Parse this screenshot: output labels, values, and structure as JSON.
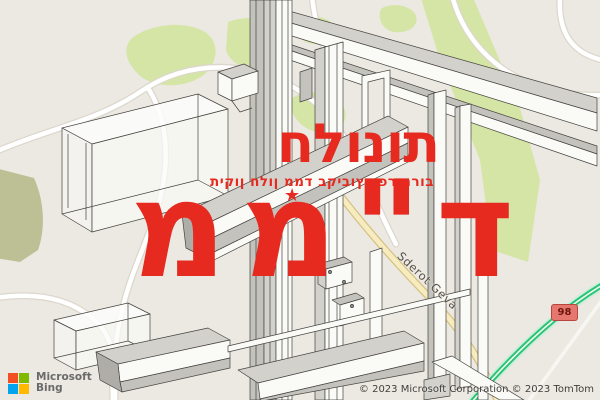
{
  "overlay": {
    "title": "חלונות",
    "subtitle": "תיקון חלון ממד בקיבוץ כפר חרוב",
    "main_word": "ממ\"ד",
    "star_icon": "★",
    "accent_color": "#e62a1f"
  },
  "map": {
    "road_label": "Sderot Geva",
    "route_badge": "98",
    "colors": {
      "background": "#ece9e2",
      "park_green": "#d5e5a5",
      "highway_green": "#2bc473",
      "road_yellow": "#f7ecc0",
      "badge_bg": "#e5776e"
    }
  },
  "attribution": {
    "logo_line1": "Microsoft",
    "logo_line2": "Bing",
    "logo_colors": [
      "#f25022",
      "#7fba00",
      "#00a4ef",
      "#ffb900"
    ],
    "copyright": "© 2023 Microsoft Corporation © 2023 TomTom"
  }
}
